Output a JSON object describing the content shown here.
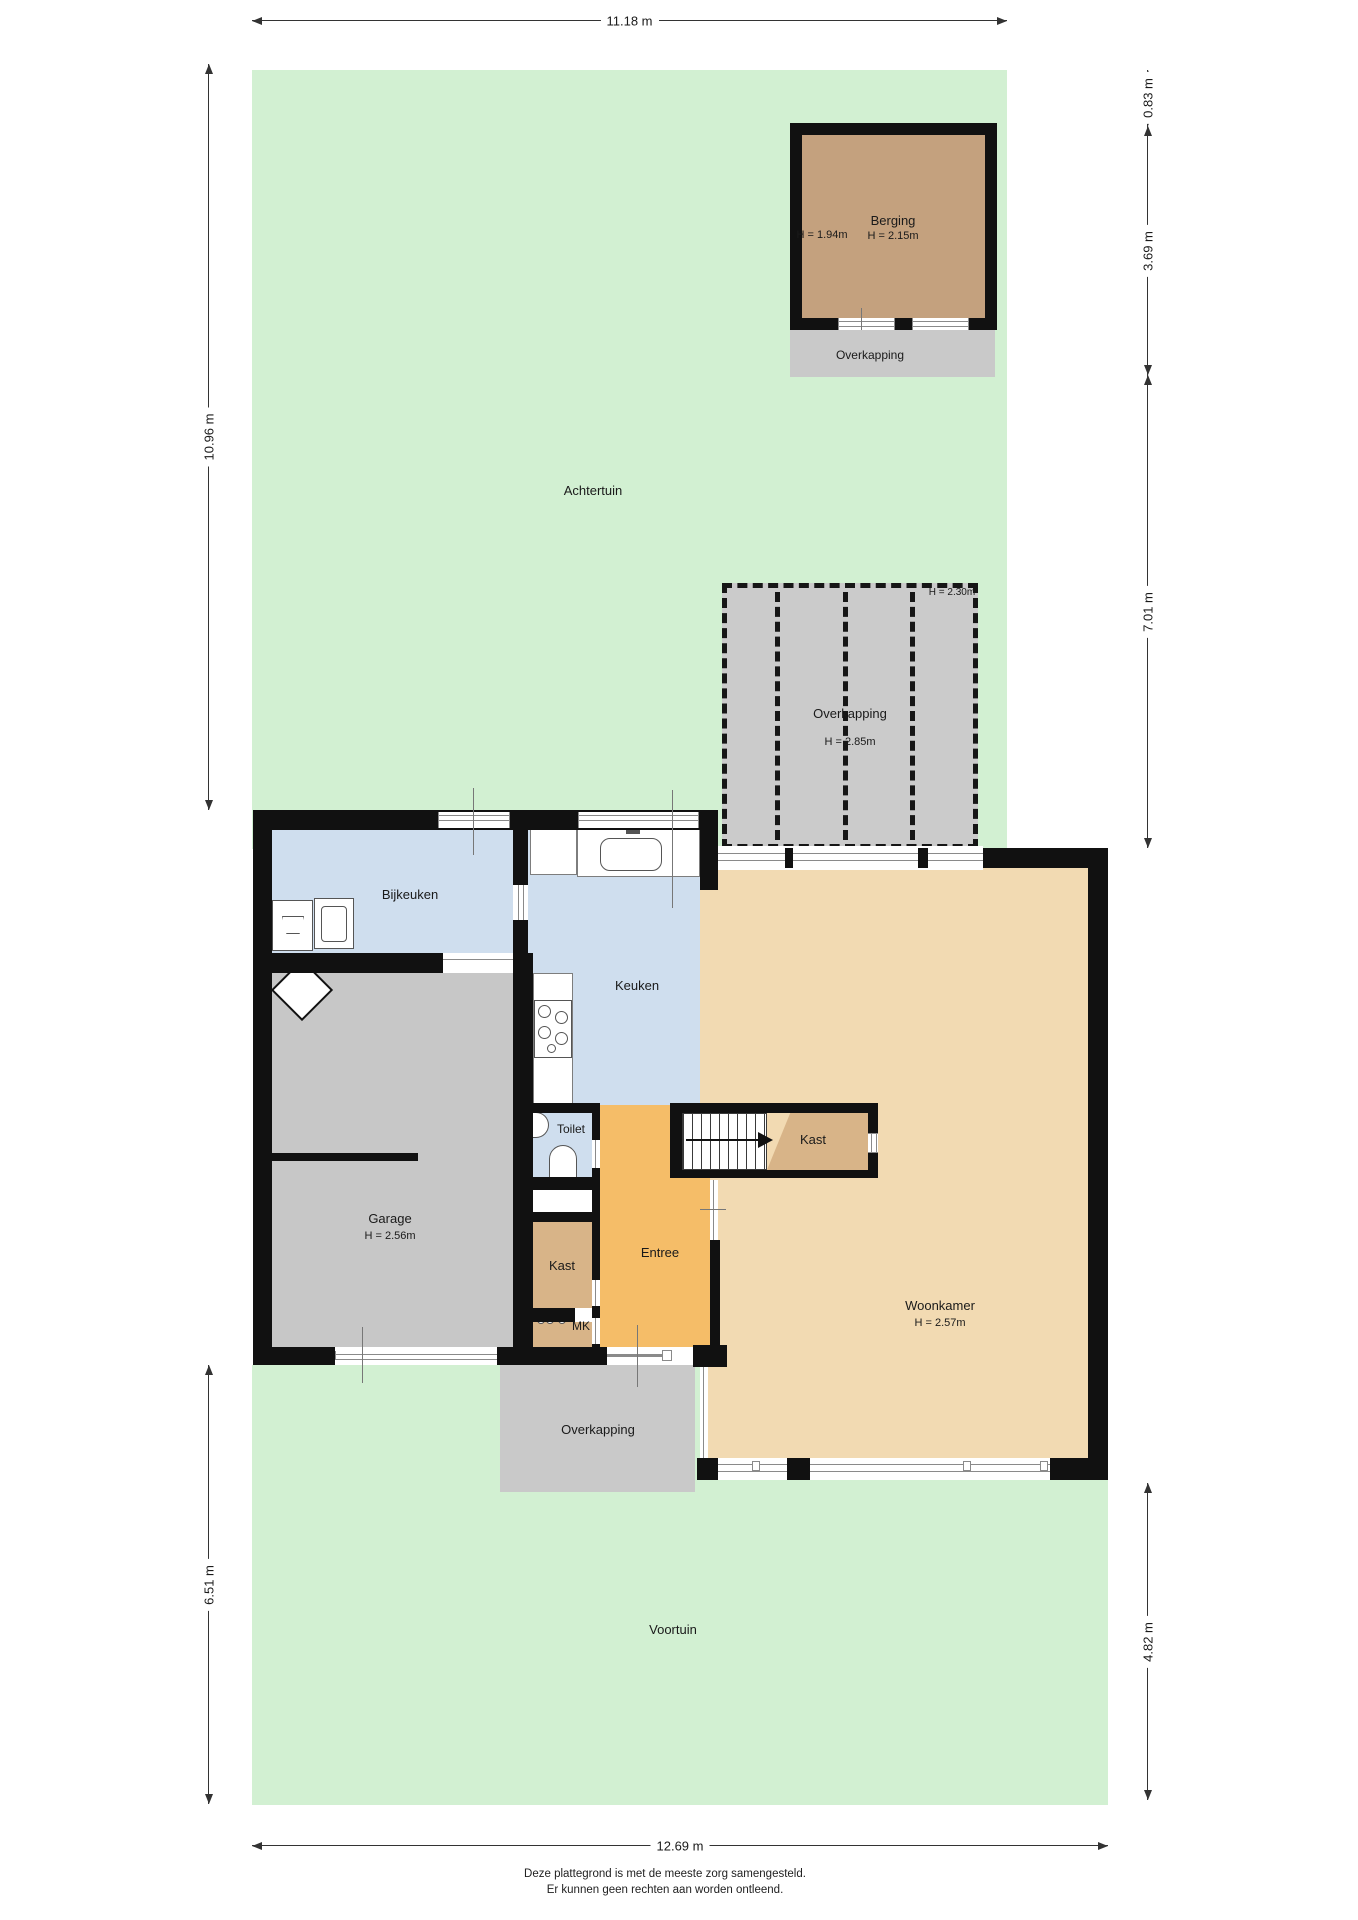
{
  "dimensions": {
    "top": "11.18 m",
    "bottom": "12.69 m",
    "left_upper": "10.96 m",
    "left_lower": "6.51 m",
    "right_1": "0.83 m",
    "right_2": "3.69 m",
    "right_3": "7.01 m",
    "right_4": "4.82 m"
  },
  "rooms": {
    "achtertuin": "Achtertuin",
    "voortuin": "Voortuin",
    "berging": {
      "name": "Berging",
      "height_left": "H = 1.94m",
      "height": "H = 2.15m"
    },
    "overkapping_top": "Overkapping",
    "pergola": {
      "name": "Overkapping",
      "height": "H = 2.85m",
      "height_corner": "H = 2.30m"
    },
    "bijkeuken": "Bijkeuken",
    "keuken": "Keuken",
    "garage": {
      "name": "Garage",
      "height": "H = 2.56m"
    },
    "toilet": "Toilet",
    "kast_hal": "Kast",
    "kast_trap": "Kast",
    "mk": "MK",
    "entree": "Entree",
    "woonkamer": {
      "name": "Woonkamer",
      "height": "H = 2.57m"
    },
    "overkapping_voor": "Overkapping"
  },
  "footer": {
    "line1": "Deze plattegrond is met de meeste zorg samengesteld.",
    "line2": "Er kunnen geen rechten aan worden ontleend."
  },
  "colors": {
    "garden_green": "#d2f0d2",
    "wall_black": "#111111",
    "berging_brown": "#c4a17e",
    "room_tan": "#f2dab2",
    "closet_tan": "#d8b488",
    "entree_orange": "#f5bd68",
    "wet_blue": "#cfdeee",
    "garage_gray": "#c7c7c7",
    "overkapping_gray": "#c9c9c9"
  }
}
